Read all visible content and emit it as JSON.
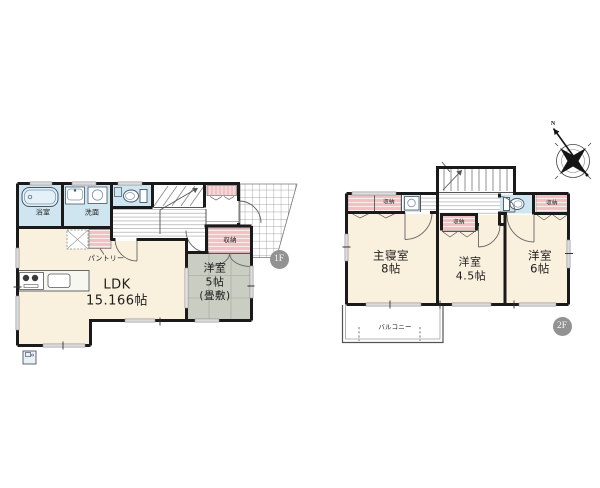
{
  "floor1": {
    "badge": "1F",
    "labels": {
      "bathroom": "浴室",
      "washroom": "洗面",
      "pantry": "パントリー",
      "closet": "収納",
      "ldk_name": "LDK",
      "ldk_size": "15.166帖",
      "tatami_name": "洋室",
      "tatami_size": "5帖",
      "tatami_note": "(畳敷)"
    }
  },
  "floor2": {
    "badge": "2F",
    "labels": {
      "closet_top_left": "収納",
      "closet_middle": "収納",
      "closet_top_right": "収納",
      "master_name": "主寝室",
      "master_size": "8帖",
      "west45_name": "洋室",
      "west45_size": "4.5帖",
      "west6_name": "洋室",
      "west6_size": "6帖",
      "balcony": "バルコニー"
    }
  },
  "compass": {
    "north": "N"
  },
  "colors": {
    "room_cream": "#FAF0DE",
    "wet_area_blue": "#CFE5F0",
    "closet_pink": "#F2C1C4",
    "tatami_gray": "#C9CDC2",
    "wall_black": "#1a1a1a",
    "badge_gray": "#929292"
  }
}
